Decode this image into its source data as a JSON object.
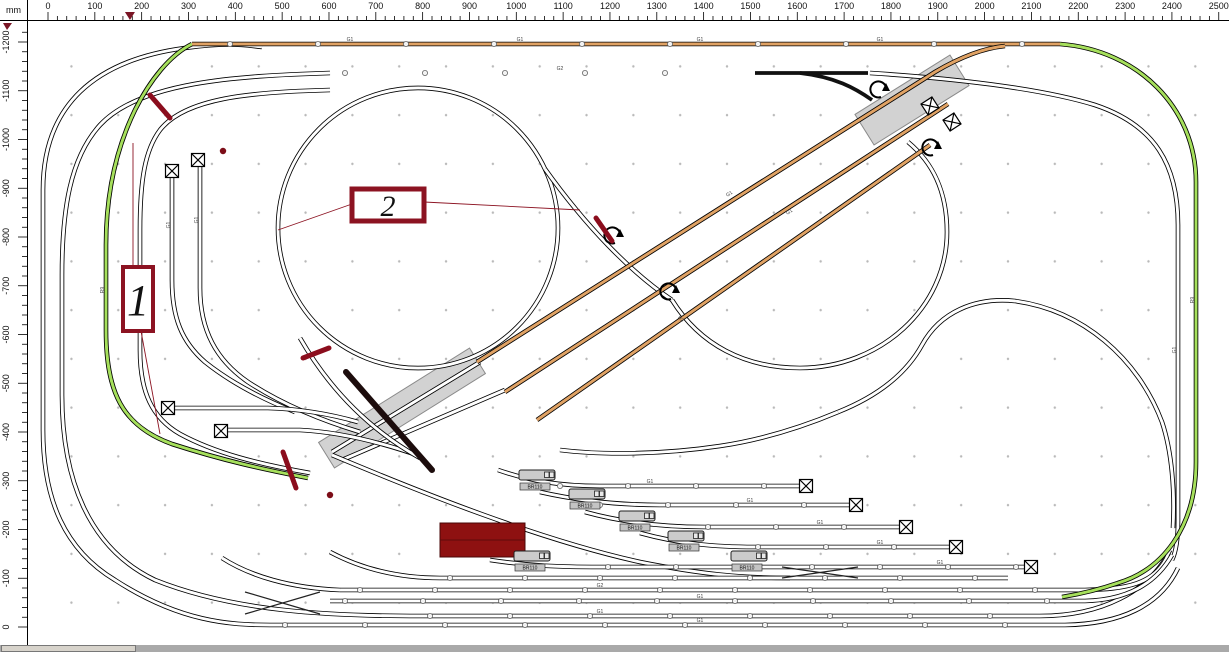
{
  "app": {
    "unit_label": "mm"
  },
  "rulers": {
    "top": {
      "origin_px": 48,
      "px_per_mm": 0.4683,
      "min_mm": 0,
      "max_mm": 2520,
      "step_mm": 20,
      "label_every_mm": 100,
      "marker_mm": 175
    },
    "left": {
      "origin_px": 627,
      "px_per_mm": 0.4875,
      "min_mm": 0,
      "max_mm": 1220,
      "step_mm": 20,
      "label_every_mm": 100,
      "marker_at_top": true
    }
  },
  "colors": {
    "track_white": "#ffffff",
    "track_green": "#a6e05c",
    "track_orange": "#e0a264",
    "bridge": "#d2d2d2",
    "accent_red": "#8b0d1d",
    "callout_red": "#8c1322",
    "building": "#8e1111",
    "wall": "#1c0c0c"
  },
  "plan": {
    "bridges": [
      {
        "cx": 402,
        "cy": 408,
        "w": 178,
        "h": 30,
        "a": -32
      },
      {
        "cx": 912,
        "cy": 100,
        "w": 112,
        "h": 36,
        "a": -32
      }
    ],
    "tracks": [
      {
        "c": "white",
        "d": "M43,430 L43,190 C43,105 95,60 185,48 C220,43 240,44 262,47"
      },
      {
        "c": "white",
        "d": "M43,430 C43,500 65,550 115,580 C180,622 230,625 270,625"
      },
      {
        "c": "white",
        "d": "M330,73 C235,76 140,82 100,125 C70,158 62,210 62,275 L62,395 C62,478 88,548 155,580 C235,612 330,616 420,616 L1040,616 C1100,616 1150,592 1170,550"
      },
      {
        "c": "white",
        "d": "M330,90 C250,92 185,98 160,130 C145,150 140,180 140,230 L140,350 C140,392 152,418 180,434 C215,453 258,464 310,473"
      },
      {
        "c": "white",
        "d": "M270,625 L1065,625 C1120,624 1160,606 1178,568"
      },
      {
        "c": "white",
        "d": "M278,228 A140,140 0 1 0 558,228 A140,140 0 1 0 278,228"
      },
      {
        "c": "white",
        "d": "M545,169 C585,225 630,272 672,300"
      },
      {
        "c": "white",
        "d": "M672,300 C700,345 745,368 800,368 C880,368 947,308 947,232 C947,190 932,162 908,142"
      },
      {
        "c": "white",
        "d": "M838,412 C878,396 906,374 922,345 C940,312 975,297 1015,301 C1082,310 1138,358 1162,422 C1172,452 1175,492 1173,528"
      },
      {
        "c": "white",
        "d": "M838,412 C800,428 760,440 720,446 C660,455 600,455 560,450"
      },
      {
        "c": "white",
        "d": "M870,73 C950,78 1040,88 1095,105 C1155,125 1178,165 1178,225 L1178,520 C1178,540 1176,552 1172,560"
      },
      {
        "c": "white",
        "d": "M332,452 L480,362"
      },
      {
        "c": "white",
        "d": "M342,460 L505,390"
      },
      {
        "c": "white",
        "d": "M172,170 L172,280 C172,318 182,342 205,362 C230,382 260,398 295,412"
      },
      {
        "c": "white",
        "d": "M200,160 L200,288 C200,330 216,360 248,382 C280,403 320,420 360,432"
      },
      {
        "c": "white",
        "d": "M166,408 L268,408 C300,409 330,414 358,422"
      },
      {
        "c": "white",
        "d": "M219,430 L300,430 C340,432 380,442 420,456"
      },
      {
        "c": "white",
        "d": "M300,338 C330,390 370,430 420,458"
      },
      {
        "c": "white",
        "d": "M332,455 C420,492 540,540 640,562 C700,574 740,578 790,578"
      },
      {
        "c": "white",
        "d": "M498,470 C530,481 560,486 600,486 L800,486"
      },
      {
        "c": "white",
        "d": "M540,492 C580,501 620,505 660,505 L850,505"
      },
      {
        "c": "white",
        "d": "M585,512 C625,523 665,527 705,527 L900,527"
      },
      {
        "c": "white",
        "d": "M640,533 C680,544 715,547 755,547 L950,547"
      },
      {
        "c": "white",
        "d": "M490,560 C530,566 560,567 600,567 L1025,567"
      },
      {
        "c": "white",
        "d": "M330,552 C360,568 395,578 440,578 L1008,578"
      },
      {
        "c": "white",
        "d": "M340,590 L1085,590 C1125,589 1155,585 1168,555"
      },
      {
        "c": "white",
        "d": "M340,590 C290,588 250,576 222,558"
      },
      {
        "c": "white",
        "d": "M330,601 L1085,601 C1125,600 1155,585 1172,555"
      },
      {
        "c": "green",
        "d": "M192,44 C170,55 150,80 135,110 C118,145 106,190 106,245 L106,330 C106,392 122,426 172,444 C225,461 262,469 308,478"
      },
      {
        "c": "green",
        "d": "M1060,44 C1138,50 1196,108 1196,182 L1196,462 C1196,528 1162,570 1118,583 C1098,590 1080,594 1062,597"
      },
      {
        "c": "orange",
        "d": "M192,44 L1060,44"
      },
      {
        "c": "orange",
        "d": "M477,362 L935,72 C962,56 985,48 1005,46"
      },
      {
        "c": "orange",
        "d": "M505,392 L948,104"
      },
      {
        "c": "orange",
        "d": "M537,420 L930,145"
      },
      {
        "c": "thin",
        "d": "M245,592 L320,614"
      },
      {
        "c": "thin",
        "d": "M245,614 L320,592"
      },
      {
        "c": "thin",
        "d": "M782,578 L858,567"
      },
      {
        "c": "thin",
        "d": "M782,567 L858,578"
      },
      {
        "c": "bold",
        "d": "M755,73 L868,73"
      },
      {
        "c": "bold",
        "d": "M800,73 C835,77 855,88 872,100"
      }
    ],
    "joints": [
      {
        "y": 44,
        "x1": 230,
        "x2": 1040,
        "s": 88
      },
      {
        "y": 73,
        "x1": 345,
        "x2": 740,
        "s": 80
      },
      {
        "y": 486,
        "x1": 560,
        "x2": 795,
        "s": 68
      },
      {
        "y": 505,
        "x1": 600,
        "x2": 845,
        "s": 68
      },
      {
        "y": 527,
        "x1": 640,
        "x2": 895,
        "s": 68
      },
      {
        "y": 547,
        "x1": 690,
        "x2": 945,
        "s": 68
      },
      {
        "y": 567,
        "x1": 540,
        "x2": 1020,
        "s": 68
      },
      {
        "y": 578,
        "x1": 450,
        "x2": 1000,
        "s": 75
      },
      {
        "y": 590,
        "x1": 360,
        "x2": 1075,
        "s": 75
      },
      {
        "y": 601,
        "x1": 345,
        "x2": 1080,
        "s": 78
      },
      {
        "y": 616,
        "x1": 430,
        "x2": 1035,
        "s": 80
      },
      {
        "y": 625,
        "x1": 285,
        "x2": 1055,
        "s": 80
      }
    ],
    "track_labels": [
      {
        "x": 350,
        "y": 41,
        "t": "G1"
      },
      {
        "x": 520,
        "y": 41,
        "t": "G1"
      },
      {
        "x": 700,
        "y": 41,
        "t": "G1"
      },
      {
        "x": 880,
        "y": 41,
        "t": "G1"
      },
      {
        "x": 560,
        "y": 70,
        "t": "G2"
      },
      {
        "x": 650,
        "y": 483,
        "t": "G1"
      },
      {
        "x": 750,
        "y": 502,
        "t": "G1"
      },
      {
        "x": 820,
        "y": 524,
        "t": "G1"
      },
      {
        "x": 880,
        "y": 544,
        "t": "G1"
      },
      {
        "x": 940,
        "y": 564,
        "t": "G1"
      },
      {
        "x": 600,
        "y": 587,
        "t": "G2"
      },
      {
        "x": 700,
        "y": 598,
        "t": "G1"
      },
      {
        "x": 600,
        "y": 613,
        "t": "G1"
      },
      {
        "x": 700,
        "y": 622,
        "t": "G1"
      },
      {
        "x": 170,
        "y": 225,
        "t": "G1",
        "r": -90
      },
      {
        "x": 198,
        "y": 220,
        "t": "G1",
        "r": -90
      },
      {
        "x": 104,
        "y": 290,
        "t": "R9",
        "r": -90
      },
      {
        "x": 730,
        "y": 195,
        "t": "G1",
        "r": -33
      },
      {
        "x": 790,
        "y": 213,
        "t": "G1",
        "r": -33
      },
      {
        "x": 680,
        "y": 320,
        "t": "R2",
        "r": 40
      },
      {
        "x": 1176,
        "y": 350,
        "t": "G1",
        "r": -90
      },
      {
        "x": 1194,
        "y": 300,
        "t": "R9",
        "r": -90
      }
    ],
    "bumpers": [
      {
        "x": 172,
        "y": 171,
        "r": 0
      },
      {
        "x": 198,
        "y": 160,
        "r": 0
      },
      {
        "x": 168,
        "y": 408,
        "r": 0
      },
      {
        "x": 221,
        "y": 431,
        "r": 0
      },
      {
        "x": 806,
        "y": 486,
        "r": 0
      },
      {
        "x": 856,
        "y": 505,
        "r": 0
      },
      {
        "x": 906,
        "y": 527,
        "r": 0
      },
      {
        "x": 956,
        "y": 547,
        "r": 0
      },
      {
        "x": 1031,
        "y": 567,
        "r": 0
      },
      {
        "x": 930,
        "y": 106,
        "r": -33
      },
      {
        "x": 952,
        "y": 122,
        "r": -33
      }
    ],
    "turn_arrows": [
      {
        "x": 878,
        "y": 90
      },
      {
        "x": 930,
        "y": 148
      },
      {
        "x": 668,
        "y": 292
      },
      {
        "x": 612,
        "y": 236
      }
    ],
    "locos": [
      {
        "x": 519,
        "y": 470,
        "label": "BR110"
      },
      {
        "x": 569,
        "y": 489,
        "label": "BR110"
      },
      {
        "x": 619,
        "y": 511,
        "label": "BR110"
      },
      {
        "x": 668,
        "y": 531,
        "label": "BR110"
      },
      {
        "x": 731,
        "y": 551,
        "label": "BR110"
      },
      {
        "x": 514,
        "y": 551,
        "label": "BR110"
      }
    ],
    "building": {
      "x": 440,
      "y": 523,
      "w": 85,
      "h": 34
    },
    "wall": {
      "d": "M346,372 L432,470"
    },
    "uncoupler_strokes": [
      {
        "x1": 150,
        "y1": 95,
        "x2": 170,
        "y2": 118
      },
      {
        "x1": 303,
        "y1": 358,
        "x2": 329,
        "y2": 348
      },
      {
        "x1": 283,
        "y1": 452,
        "x2": 296,
        "y2": 488
      },
      {
        "x1": 596,
        "y1": 218,
        "x2": 612,
        "y2": 241
      }
    ],
    "dots": [
      {
        "x": 223,
        "y": 151
      },
      {
        "x": 330,
        "y": 495
      }
    ],
    "callouts": [
      {
        "text": "1",
        "x": 123,
        "y": 267,
        "w": 30,
        "h": 64,
        "bw": 4,
        "fs": 44,
        "leaders": [
          [
            133,
            267,
            133,
            143
          ],
          [
            141,
            331,
            160,
            434
          ]
        ]
      },
      {
        "text": "2",
        "x": 352,
        "y": 189,
        "w": 72,
        "h": 32,
        "bw": 5,
        "fs": 30,
        "leaders": [
          [
            352,
            204,
            278,
            230
          ],
          [
            424,
            202,
            580,
            210
          ]
        ]
      }
    ]
  }
}
